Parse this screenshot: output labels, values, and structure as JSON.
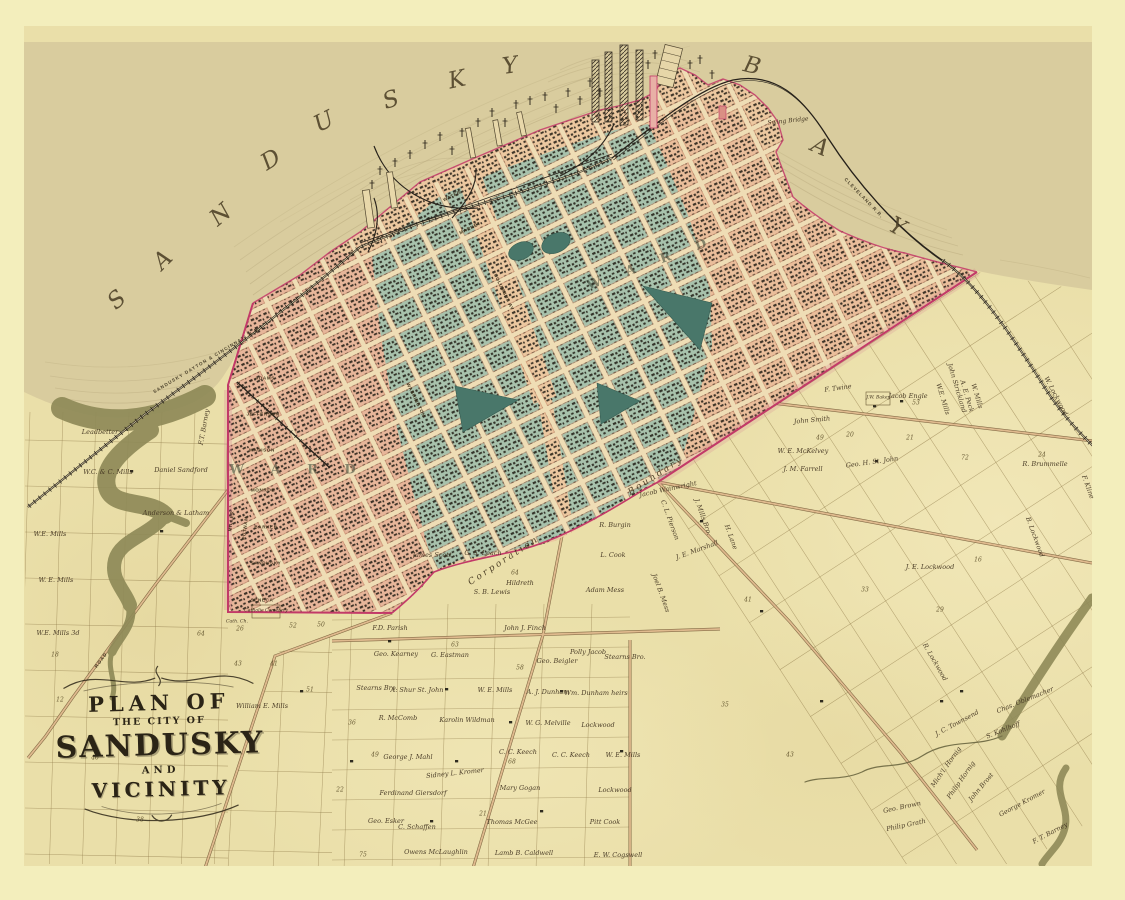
{
  "map": {
    "title": "Plan of the City of Sandusky and Vicinity",
    "water_body_name": "SANDUSKY BAY",
    "cartouche": {
      "line1": "PLAN OF",
      "line2": "THE CITY OF",
      "line3": "SANDUSKY",
      "line4": "AND",
      "line5": "VICINITY"
    },
    "colors": {
      "margin": "#f3eebc",
      "paper": "#eadfa9",
      "bay": "#d9cc9e",
      "teal_blocks": "#a8c2ac",
      "salmon_blocks": "#ecc8a0",
      "rose_blocks": "#e2a294",
      "park_green": "#49776a",
      "boundary_crimson": "#c23a68",
      "creek_olive": "#8f8a58",
      "ink": "#3e3120",
      "rail_dark": "#26211a"
    },
    "bay_letters": [
      {
        "t": "S",
        "x": 117,
        "y": 300,
        "r": -42
      },
      {
        "t": "A",
        "x": 163,
        "y": 260,
        "r": -45
      },
      {
        "t": "N",
        "x": 221,
        "y": 215,
        "r": -40
      },
      {
        "t": "D",
        "x": 271,
        "y": 160,
        "r": -32
      },
      {
        "t": "U",
        "x": 324,
        "y": 122,
        "r": -26
      },
      {
        "t": "S",
        "x": 391,
        "y": 100,
        "r": -18
      },
      {
        "t": "K",
        "x": 457,
        "y": 80,
        "r": -12
      },
      {
        "t": "Y",
        "x": 510,
        "y": 66,
        "r": -8
      },
      {
        "t": "B",
        "x": 752,
        "y": 66,
        "r": 14
      },
      {
        "t": "A",
        "x": 820,
        "y": 147,
        "r": 24
      },
      {
        "t": "Y",
        "x": 897,
        "y": 227,
        "r": 28
      }
    ],
    "boundary_labels": [
      {
        "t": "Corporation",
        "x": 504,
        "y": 561,
        "r": -33
      },
      {
        "t": "Boundary",
        "x": 656,
        "y": 476,
        "r": -33
      }
    ],
    "railroad_labels": [
      {
        "t": "SANDUSKY DAYTON & CINCINNATI R.R.",
        "x": 207,
        "y": 360,
        "r": -31
      },
      {
        "t": "CLEVELAND R.R.",
        "x": 864,
        "y": 198,
        "r": 46
      },
      {
        "t": "ROAD",
        "x": 101,
        "y": 660,
        "r": -53
      }
    ],
    "bridge_label": {
      "t": "Swing Bridge",
      "x": 788,
      "y": 121,
      "r": -6
    },
    "ward_labels": [
      {
        "t": "W A R D",
        "x": 298,
        "y": 470,
        "r": 0
      },
      {
        "t": "W A R D",
        "x": 652,
        "y": 263,
        "r": -20
      }
    ],
    "poi_labels": [
      {
        "t": "Catholic Cemetery",
        "x": 266,
        "y": 611,
        "r": 0
      },
      {
        "t": "Cath. Ch.",
        "x": 237,
        "y": 622,
        "r": 0
      },
      {
        "t": "J.W. Baker",
        "x": 878,
        "y": 398,
        "r": 0
      }
    ],
    "street_labels": [
      {
        "t": "ADAMS",
        "x": 265,
        "y": 378,
        "r": 0
      },
      {
        "t": "JEFFERSON",
        "x": 263,
        "y": 414,
        "r": 0
      },
      {
        "t": "MADISON",
        "x": 262,
        "y": 450,
        "r": 0
      },
      {
        "t": "MONROE",
        "x": 263,
        "y": 490,
        "r": 0
      },
      {
        "t": "BARKER",
        "x": 266,
        "y": 527,
        "r": 0
      },
      {
        "t": "SANDUSKY",
        "x": 266,
        "y": 563,
        "r": 0
      },
      {
        "t": "SENECA",
        "x": 262,
        "y": 600,
        "r": 0
      },
      {
        "t": "MILLER",
        "x": 231,
        "y": 521,
        "r": -83
      },
      {
        "t": "PUTNAM",
        "x": 245,
        "y": 528,
        "r": -83
      },
      {
        "t": "WATER",
        "x": 452,
        "y": 196,
        "r": -26
      },
      {
        "t": "MARKET",
        "x": 470,
        "y": 228,
        "r": -26
      },
      {
        "t": "WASHINGTON",
        "x": 416,
        "y": 400,
        "r": 64
      },
      {
        "t": "COLUMBUS AV",
        "x": 504,
        "y": 292,
        "r": 64
      }
    ],
    "farm_labels": [
      {
        "t": "Leadbetter",
        "x": 100,
        "y": 432,
        "r": 0
      },
      {
        "t": "W.C. & C. Mills",
        "x": 108,
        "y": 472,
        "r": 0
      },
      {
        "t": "Daniel Sandford",
        "x": 181,
        "y": 470,
        "r": 0
      },
      {
        "t": "Anderson & Latham",
        "x": 176,
        "y": 513,
        "r": 0
      },
      {
        "t": "W.E. Mills",
        "x": 50,
        "y": 534,
        "r": 0
      },
      {
        "t": "W. E. Mills",
        "x": 56,
        "y": 580,
        "r": 0
      },
      {
        "t": "W.E. Mills 3d",
        "x": 58,
        "y": 633,
        "r": 0
      },
      {
        "t": "F.T. Barney",
        "x": 204,
        "y": 427,
        "r": -80
      },
      {
        "t": "William E. Mills",
        "x": 262,
        "y": 706,
        "r": 0
      },
      {
        "t": "F.D. Parish",
        "x": 390,
        "y": 628,
        "r": 0
      },
      {
        "t": "John J. Finch",
        "x": 525,
        "y": 628,
        "r": 0
      },
      {
        "t": "Geo. Kearney",
        "x": 396,
        "y": 654,
        "r": 0
      },
      {
        "t": "G. Eastman",
        "x": 450,
        "y": 655,
        "r": 0
      },
      {
        "t": "Geo. Beigler",
        "x": 557,
        "y": 661,
        "r": 0
      },
      {
        "t": "Polly Jacob",
        "x": 588,
        "y": 652,
        "r": 0
      },
      {
        "t": "Stearns Bro.",
        "x": 625,
        "y": 657,
        "r": 0
      },
      {
        "t": "Stearns Bro.",
        "x": 377,
        "y": 688,
        "r": 0
      },
      {
        "t": "A. Shur St. John",
        "x": 417,
        "y": 690,
        "r": 0
      },
      {
        "t": "W. E. Mills",
        "x": 495,
        "y": 690,
        "r": 0
      },
      {
        "t": "A. J. Dunham",
        "x": 548,
        "y": 692,
        "r": 0
      },
      {
        "t": "Wm. Dunham heirs",
        "x": 596,
        "y": 693,
        "r": 0
      },
      {
        "t": "R. McComb",
        "x": 398,
        "y": 718,
        "r": 0
      },
      {
        "t": "Karolin Wildman",
        "x": 467,
        "y": 720,
        "r": 0
      },
      {
        "t": "W. G. Melville",
        "x": 548,
        "y": 723,
        "r": 0
      },
      {
        "t": "Lockwood",
        "x": 598,
        "y": 725,
        "r": 0
      },
      {
        "t": "George J. Mahl",
        "x": 408,
        "y": 757,
        "r": 0
      },
      {
        "t": "C. C. Keech",
        "x": 518,
        "y": 752,
        "r": 0
      },
      {
        "t": "C. C. Keech",
        "x": 571,
        "y": 755,
        "r": 0
      },
      {
        "t": "W. E. Mills",
        "x": 623,
        "y": 755,
        "r": 0
      },
      {
        "t": "Sidney L. Kromer",
        "x": 455,
        "y": 773,
        "r": -6
      },
      {
        "t": "Ferdinand Giersdorf",
        "x": 413,
        "y": 793,
        "r": 0
      },
      {
        "t": "Mary Gogan",
        "x": 520,
        "y": 788,
        "r": 0
      },
      {
        "t": "Lockwood",
        "x": 615,
        "y": 790,
        "r": 0
      },
      {
        "t": "Geo. Esker",
        "x": 386,
        "y": 821,
        "r": 0
      },
      {
        "t": "C. Schaffen",
        "x": 417,
        "y": 827,
        "r": 0
      },
      {
        "t": "Thomas McGee",
        "x": 512,
        "y": 822,
        "r": 0
      },
      {
        "t": "Pitt Cook",
        "x": 605,
        "y": 822,
        "r": 0
      },
      {
        "t": "Owens McLaughlin",
        "x": 436,
        "y": 852,
        "r": 0
      },
      {
        "t": "Lamb B. Caldwell",
        "x": 524,
        "y": 853,
        "r": 0
      },
      {
        "t": "E. W. Cogswell",
        "x": 618,
        "y": 855,
        "r": 0
      },
      {
        "t": "Jacob Engle",
        "x": 908,
        "y": 396,
        "r": 0
      },
      {
        "t": "W.E. Mills",
        "x": 943,
        "y": 399,
        "r": 73
      },
      {
        "t": "John Strickland",
        "x": 957,
        "y": 388,
        "r": 73
      },
      {
        "t": "A. E. Peck",
        "x": 967,
        "y": 396,
        "r": 73
      },
      {
        "t": "W. Mills",
        "x": 977,
        "y": 396,
        "r": 73
      },
      {
        "t": "W. Lockwood",
        "x": 1056,
        "y": 396,
        "r": 62
      },
      {
        "t": "Geo. H. St. John",
        "x": 872,
        "y": 462,
        "r": -8
      },
      {
        "t": "R. Brummelle",
        "x": 1045,
        "y": 464,
        "r": 0
      },
      {
        "t": "F. Kline",
        "x": 1088,
        "y": 487,
        "r": 70
      },
      {
        "t": "B. Lockwood",
        "x": 1035,
        "y": 537,
        "r": 70
      },
      {
        "t": "J. E. Lockwood",
        "x": 930,
        "y": 567,
        "r": 0
      },
      {
        "t": "R. Lockwood",
        "x": 935,
        "y": 662,
        "r": 60
      },
      {
        "t": "Chas. Oblemacher",
        "x": 1025,
        "y": 700,
        "r": -22
      },
      {
        "t": "J. C. Townsend",
        "x": 957,
        "y": 723,
        "r": -28
      },
      {
        "t": "S. Kohlhoff",
        "x": 1003,
        "y": 730,
        "r": -22
      },
      {
        "t": "Mich'l. Hornig",
        "x": 946,
        "y": 767,
        "r": -55
      },
      {
        "t": "Philip Hornig",
        "x": 961,
        "y": 780,
        "r": -55
      },
      {
        "t": "John Brost",
        "x": 981,
        "y": 787,
        "r": -50
      },
      {
        "t": "George Kromer",
        "x": 1022,
        "y": 803,
        "r": -28
      },
      {
        "t": "F. T. Barney",
        "x": 1050,
        "y": 833,
        "r": -28
      },
      {
        "t": "Geo. Brown",
        "x": 902,
        "y": 807,
        "r": -12
      },
      {
        "t": "Philip Grath",
        "x": 906,
        "y": 825,
        "r": -12
      },
      {
        "t": "F. Twine",
        "x": 838,
        "y": 388,
        "r": -8
      },
      {
        "t": "John Smith",
        "x": 812,
        "y": 420,
        "r": -5
      },
      {
        "t": "W. E. McKelvey",
        "x": 803,
        "y": 451,
        "r": 0
      },
      {
        "t": "J. M. Farrell",
        "x": 803,
        "y": 469,
        "r": 0
      },
      {
        "t": "R. Burgin",
        "x": 615,
        "y": 525,
        "r": 0
      },
      {
        "t": "L. Cook",
        "x": 613,
        "y": 555,
        "r": 0
      },
      {
        "t": "Jacob Wainwright",
        "x": 668,
        "y": 489,
        "r": -12
      },
      {
        "t": "C. L. Pierson",
        "x": 670,
        "y": 520,
        "r": 70
      },
      {
        "t": "J. Mills Bro.",
        "x": 703,
        "y": 517,
        "r": 70
      },
      {
        "t": "J. E. Marshall",
        "x": 697,
        "y": 550,
        "r": -20
      },
      {
        "t": "H. Lane",
        "x": 731,
        "y": 537,
        "r": 70
      },
      {
        "t": "Joel B. Mess",
        "x": 661,
        "y": 593,
        "r": 70
      },
      {
        "t": "S. B. Lewis",
        "x": 492,
        "y": 592,
        "r": 0
      },
      {
        "t": "G. S. Leach",
        "x": 483,
        "y": 553,
        "r": 0
      },
      {
        "t": "James Scott",
        "x": 432,
        "y": 555,
        "r": 0
      },
      {
        "t": "Hildreth",
        "x": 520,
        "y": 583,
        "r": 0
      },
      {
        "t": "Adam Mess",
        "x": 605,
        "y": 590,
        "r": 0
      }
    ],
    "parcel_numbers": [
      {
        "t": "51",
        "x": 310,
        "y": 690
      },
      {
        "t": "63",
        "x": 455,
        "y": 645
      },
      {
        "t": "58",
        "x": 520,
        "y": 668
      },
      {
        "t": "36",
        "x": 352,
        "y": 723
      },
      {
        "t": "49",
        "x": 375,
        "y": 755
      },
      {
        "t": "22",
        "x": 340,
        "y": 790
      },
      {
        "t": "75",
        "x": 363,
        "y": 855
      },
      {
        "t": "12",
        "x": 60,
        "y": 700
      },
      {
        "t": "46",
        "x": 95,
        "y": 758
      },
      {
        "t": "38",
        "x": 140,
        "y": 820
      },
      {
        "t": "24",
        "x": 1042,
        "y": 455
      },
      {
        "t": "41",
        "x": 748,
        "y": 600
      },
      {
        "t": "33",
        "x": 865,
        "y": 590
      },
      {
        "t": "29",
        "x": 940,
        "y": 610
      },
      {
        "t": "64",
        "x": 515,
        "y": 573
      },
      {
        "t": "68",
        "x": 512,
        "y": 762
      },
      {
        "t": "18",
        "x": 55,
        "y": 655
      },
      {
        "t": "21",
        "x": 483,
        "y": 814
      },
      {
        "t": "35",
        "x": 725,
        "y": 705
      },
      {
        "t": "43",
        "x": 790,
        "y": 755
      },
      {
        "t": "16",
        "x": 978,
        "y": 560
      },
      {
        "t": "64",
        "x": 201,
        "y": 634
      },
      {
        "t": "52",
        "x": 293,
        "y": 626
      },
      {
        "t": "50",
        "x": 321,
        "y": 625
      },
      {
        "t": "43",
        "x": 238,
        "y": 664
      },
      {
        "t": "41",
        "x": 274,
        "y": 664
      },
      {
        "t": "20",
        "x": 850,
        "y": 435
      },
      {
        "t": "21",
        "x": 910,
        "y": 438
      },
      {
        "t": "49",
        "x": 820,
        "y": 438
      },
      {
        "t": "72",
        "x": 965,
        "y": 458
      },
      {
        "t": "26",
        "x": 240,
        "y": 629
      },
      {
        "t": "53",
        "x": 916,
        "y": 403
      }
    ]
  }
}
